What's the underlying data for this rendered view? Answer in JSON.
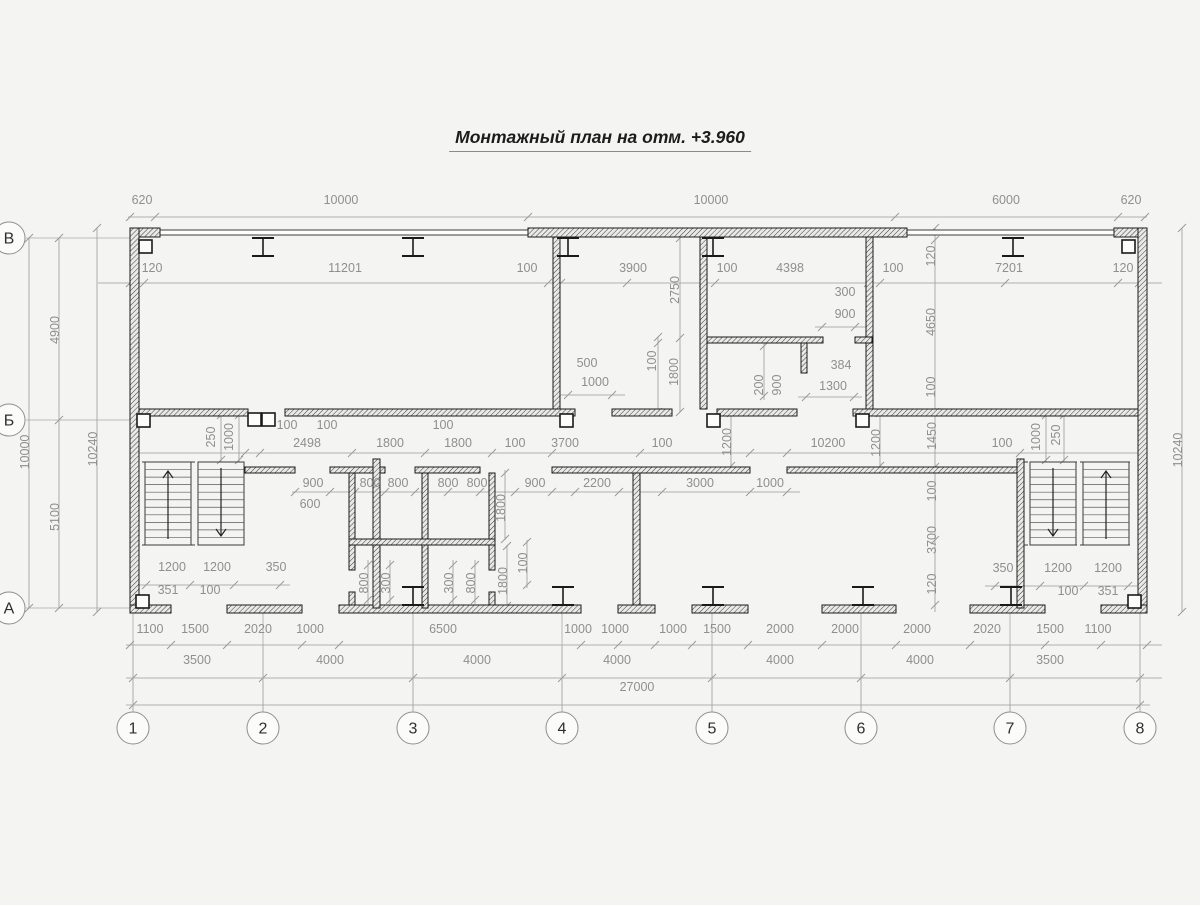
{
  "title": {
    "text": "Монтажный план на отм. +3.960"
  },
  "colors": {
    "wall": "#1a1a1a",
    "thin_wall": "#2a2a2a",
    "dim": "#9a9a9a",
    "dim_text": "#8f8f8f",
    "axis": "#a8a8a8",
    "stair": "#3a3a3a",
    "bg": "#f4f4f2"
  },
  "plan": {
    "axis_circles_bottom": [
      {
        "label": "1",
        "x": 133
      },
      {
        "label": "2",
        "x": 263
      },
      {
        "label": "3",
        "x": 413
      },
      {
        "label": "4",
        "x": 562
      },
      {
        "label": "5",
        "x": 712
      },
      {
        "label": "6",
        "x": 861
      },
      {
        "label": "7",
        "x": 1010
      },
      {
        "label": "8",
        "x": 1140
      }
    ],
    "axis_circles_left": [
      {
        "label": "В",
        "y": 238
      },
      {
        "label": "Б",
        "y": 420
      },
      {
        "label": "А",
        "y": 608
      }
    ],
    "circle_cy": 728,
    "circle_r": 16,
    "circle_cx_left": 9,
    "walls_hatched": [
      [
        130,
        228,
        30,
        9
      ],
      [
        528,
        228,
        379,
        9
      ],
      [
        1114,
        228,
        33,
        9
      ],
      [
        130,
        228,
        9,
        384
      ],
      [
        1138,
        228,
        9,
        384
      ],
      [
        130,
        605,
        41,
        8
      ],
      [
        227,
        605,
        75,
        8
      ],
      [
        339,
        605,
        242,
        8
      ],
      [
        618,
        605,
        37,
        8
      ],
      [
        692,
        605,
        56,
        8
      ],
      [
        822,
        605,
        74,
        8
      ],
      [
        970,
        605,
        75,
        8
      ],
      [
        1101,
        605,
        46,
        8
      ],
      [
        139,
        409,
        109,
        7
      ],
      [
        285,
        409,
        290,
        7
      ],
      [
        612,
        409,
        60,
        7
      ],
      [
        717,
        409,
        80,
        7
      ],
      [
        853,
        409,
        285,
        7
      ],
      [
        245,
        467,
        50,
        6
      ],
      [
        330,
        467,
        55,
        6
      ],
      [
        415,
        467,
        65,
        6
      ],
      [
        552,
        467,
        198,
        6
      ],
      [
        787,
        467,
        233,
        6
      ],
      [
        553,
        237,
        7,
        172
      ],
      [
        700,
        237,
        7,
        172
      ],
      [
        866,
        237,
        7,
        172
      ],
      [
        707,
        337,
        116,
        6
      ],
      [
        855,
        337,
        17,
        6
      ],
      [
        801,
        343,
        6,
        30
      ],
      [
        373,
        459,
        7,
        149
      ],
      [
        1017,
        459,
        7,
        149
      ],
      [
        349,
        473,
        6,
        97
      ],
      [
        349,
        592,
        6,
        13
      ],
      [
        422,
        473,
        6,
        135
      ],
      [
        489,
        473,
        6,
        97
      ],
      [
        489,
        592,
        6,
        13
      ],
      [
        349,
        539,
        146,
        6
      ],
      [
        633,
        473,
        7,
        132
      ]
    ],
    "walls_thin": [
      [
        158,
        230,
        372,
        5
      ],
      [
        905,
        230,
        211,
        5
      ]
    ],
    "columns": [
      [
        139,
        240
      ],
      [
        1122,
        240
      ],
      [
        136,
        595
      ],
      [
        1128,
        595
      ],
      [
        137,
        414
      ],
      [
        248,
        413
      ],
      [
        262,
        413
      ],
      [
        560,
        414
      ],
      [
        707,
        414
      ],
      [
        856,
        414
      ]
    ],
    "ibeams_top": [
      263,
      413,
      568,
      713,
      1013
    ],
    "ibeams_bottom": [
      413,
      563,
      713,
      863,
      1011
    ],
    "stairs": [
      {
        "x": 142,
        "w": 103,
        "y": 462,
        "h": 83,
        "flights": [
          {
            "x": 145,
            "w": 46,
            "dir": "up",
            "ax": 168
          },
          {
            "x": 198,
            "w": 46,
            "dir": "down",
            "ax": 221
          }
        ]
      },
      {
        "x": 1024,
        "w": 106,
        "y": 462,
        "h": 83,
        "flights": [
          {
            "x": 1030,
            "w": 46,
            "dir": "down",
            "ax": 1053
          },
          {
            "x": 1083,
            "w": 46,
            "dir": "up",
            "ax": 1106
          }
        ]
      }
    ],
    "axis_lines_v": {
      "xs": [
        133,
        263,
        413,
        562,
        712,
        861,
        1010,
        1140
      ],
      "y1": 612,
      "y2": 711
    },
    "axis_lines_h": {
      "ys": [
        238,
        420,
        608
      ],
      "x1": 26,
      "x2": 130
    },
    "dim_lines": [
      {
        "o": "h",
        "p": 217,
        "f": 128,
        "t": 1147,
        "ticks": [
          130,
          155,
          528,
          895,
          1118,
          1145
        ]
      },
      {
        "o": "h",
        "p": 283,
        "f": 98,
        "t": 1162,
        "ticks": [
          130,
          144,
          548,
          561,
          627,
          703,
          715,
          868,
          880,
          1005,
          1118,
          1139
        ]
      },
      {
        "o": "h",
        "p": 453,
        "f": 130,
        "t": 1147,
        "ticks": [
          245,
          260,
          352,
          425,
          492,
          552,
          640,
          750,
          787,
          1020
        ]
      },
      {
        "o": "h",
        "p": 492,
        "f": 292,
        "t": 800,
        "ticks": [
          295,
          330,
          355,
          385,
          415,
          448,
          480,
          515,
          552,
          575,
          619,
          662,
          750,
          787
        ]
      },
      {
        "o": "h",
        "p": 645,
        "f": 126,
        "t": 1162,
        "ticks": [
          130,
          171,
          227,
          302,
          339,
          581,
          618,
          655,
          692,
          748,
          822,
          896,
          970,
          1045,
          1101,
          1147
        ]
      },
      {
        "o": "h",
        "p": 678,
        "f": 126,
        "t": 1162,
        "ticks": [
          133,
          263,
          413,
          562,
          712,
          861,
          1010,
          1140
        ]
      },
      {
        "o": "h",
        "p": 705,
        "f": 126,
        "t": 1150,
        "ticks": [
          133,
          1140
        ]
      },
      {
        "o": "h",
        "p": 585,
        "f": 134,
        "t": 290,
        "ticks": [
          146,
          190,
          234,
          280
        ]
      },
      {
        "o": "h",
        "p": 586,
        "f": 985,
        "t": 1140,
        "ticks": [
          995,
          1040,
          1084,
          1128
        ]
      },
      {
        "o": "h",
        "p": 395,
        "f": 558,
        "t": 625,
        "ticks": [
          568,
          612
        ]
      },
      {
        "o": "h",
        "p": 327,
        "f": 815,
        "t": 868,
        "ticks": [
          822,
          855
        ]
      },
      {
        "o": "h",
        "p": 397,
        "f": 798,
        "t": 862,
        "ticks": [
          806,
          854
        ]
      },
      {
        "o": "v",
        "p": 29,
        "f": 238,
        "t": 608,
        "ticks": [
          238,
          608
        ]
      },
      {
        "o": "v",
        "p": 59,
        "f": 238,
        "t": 608,
        "ticks": [
          238,
          420,
          608
        ]
      },
      {
        "o": "v",
        "p": 97,
        "f": 228,
        "t": 612,
        "ticks": [
          228,
          612
        ]
      },
      {
        "o": "v",
        "p": 1182,
        "f": 228,
        "t": 612,
        "ticks": [
          228,
          612
        ]
      },
      {
        "o": "v",
        "p": 680,
        "f": 238,
        "t": 412,
        "ticks": [
          238,
          338,
          412
        ]
      },
      {
        "o": "v",
        "p": 658,
        "f": 337,
        "t": 412,
        "ticks": [
          337,
          343,
          412
        ]
      },
      {
        "o": "v",
        "p": 935,
        "f": 228,
        "t": 612,
        "ticks": [
          228,
          240,
          412,
          467,
          540,
          605
        ]
      },
      {
        "o": "v",
        "p": 731,
        "f": 412,
        "t": 467,
        "ticks": [
          413,
          466
        ]
      },
      {
        "o": "v",
        "p": 880,
        "f": 412,
        "t": 467,
        "ticks": [
          413,
          466
        ]
      },
      {
        "o": "v",
        "p": 221,
        "f": 412,
        "t": 462,
        "ticks": [
          415,
          460
        ]
      },
      {
        "o": "v",
        "p": 239,
        "f": 412,
        "t": 462,
        "ticks": [
          415,
          460
        ]
      },
      {
        "o": "v",
        "p": 1046,
        "f": 412,
        "t": 462,
        "ticks": [
          415,
          460
        ]
      },
      {
        "o": "v",
        "p": 1064,
        "f": 412,
        "t": 462,
        "ticks": [
          415,
          460
        ]
      },
      {
        "o": "v",
        "p": 505,
        "f": 470,
        "t": 540,
        "ticks": [
          473,
          539
        ]
      },
      {
        "o": "v",
        "p": 507,
        "f": 545,
        "t": 608,
        "ticks": [
          546,
          606
        ]
      },
      {
        "o": "v",
        "p": 527,
        "f": 540,
        "t": 588,
        "ticks": [
          542,
          585
        ]
      },
      {
        "o": "v",
        "p": 368,
        "f": 560,
        "t": 604,
        "ticks": [
          565,
          600
        ]
      },
      {
        "o": "v",
        "p": 390,
        "f": 560,
        "t": 604,
        "ticks": [
          565,
          600
        ]
      },
      {
        "o": "v",
        "p": 453,
        "f": 560,
        "t": 604,
        "ticks": [
          565,
          600
        ]
      },
      {
        "o": "v",
        "p": 475,
        "f": 560,
        "t": 604,
        "ticks": [
          565,
          600
        ]
      },
      {
        "o": "v",
        "p": 764,
        "f": 343,
        "t": 400,
        "ticks": [
          346,
          396
        ]
      }
    ],
    "labels": [
      {
        "t": "620",
        "x": 142,
        "y": 204
      },
      {
        "t": "10000",
        "x": 341,
        "y": 204
      },
      {
        "t": "10000",
        "x": 711,
        "y": 204
      },
      {
        "t": "6000",
        "x": 1006,
        "y": 204
      },
      {
        "t": "620",
        "x": 1131,
        "y": 204
      },
      {
        "t": "120",
        "x": 152,
        "y": 272
      },
      {
        "t": "11201",
        "x": 345,
        "y": 272
      },
      {
        "t": "100",
        "x": 527,
        "y": 272
      },
      {
        "t": "3900",
        "x": 633,
        "y": 272
      },
      {
        "t": "100",
        "x": 727,
        "y": 272
      },
      {
        "t": "4398",
        "x": 790,
        "y": 272
      },
      {
        "t": "100",
        "x": 893,
        "y": 272
      },
      {
        "t": "7201",
        "x": 1009,
        "y": 272
      },
      {
        "t": "120",
        "x": 1123,
        "y": 272
      },
      {
        "t": "4900",
        "x": 59,
        "y": 330,
        "r": 1
      },
      {
        "t": "10000",
        "x": 29,
        "y": 452,
        "r": 1
      },
      {
        "t": "5100",
        "x": 59,
        "y": 517,
        "r": 1
      },
      {
        "t": "10240",
        "x": 97,
        "y": 449,
        "r": 1
      },
      {
        "t": "10240",
        "x": 1182,
        "y": 450,
        "r": 1
      },
      {
        "t": "2750",
        "x": 679,
        "y": 290,
        "r": 1
      },
      {
        "t": "500",
        "x": 587,
        "y": 367
      },
      {
        "t": "1000",
        "x": 595,
        "y": 386
      },
      {
        "t": "100",
        "x": 656,
        "y": 361,
        "r": 1
      },
      {
        "t": "1800",
        "x": 678,
        "y": 372,
        "r": 1
      },
      {
        "t": "300",
        "x": 845,
        "y": 296
      },
      {
        "t": "900",
        "x": 845,
        "y": 318
      },
      {
        "t": "200",
        "x": 763,
        "y": 385,
        "r": 1
      },
      {
        "t": "900",
        "x": 781,
        "y": 385,
        "r": 1
      },
      {
        "t": "384",
        "x": 841,
        "y": 369
      },
      {
        "t": "1300",
        "x": 833,
        "y": 390
      },
      {
        "t": "120",
        "x": 935,
        "y": 256,
        "r": 1
      },
      {
        "t": "4650",
        "x": 935,
        "y": 322,
        "r": 1
      },
      {
        "t": "100",
        "x": 935,
        "y": 387,
        "r": 1
      },
      {
        "t": "2498",
        "x": 307,
        "y": 447
      },
      {
        "t": "1800",
        "x": 390,
        "y": 447
      },
      {
        "t": "1800",
        "x": 458,
        "y": 447
      },
      {
        "t": "100",
        "x": 515,
        "y": 447
      },
      {
        "t": "3700",
        "x": 565,
        "y": 447
      },
      {
        "t": "100",
        "x": 662,
        "y": 447
      },
      {
        "t": "10200",
        "x": 828,
        "y": 447
      },
      {
        "t": "100",
        "x": 1002,
        "y": 447
      },
      {
        "t": "100",
        "x": 287,
        "y": 429
      },
      {
        "t": "100",
        "x": 327,
        "y": 429
      },
      {
        "t": "100",
        "x": 443,
        "y": 429
      },
      {
        "t": "250",
        "x": 215,
        "y": 437,
        "r": 1
      },
      {
        "t": "1000",
        "x": 233,
        "y": 437,
        "r": 1
      },
      {
        "t": "1200",
        "x": 731,
        "y": 442,
        "r": 1
      },
      {
        "t": "1200",
        "x": 880,
        "y": 443,
        "r": 1
      },
      {
        "t": "1450",
        "x": 936,
        "y": 436,
        "r": 1
      },
      {
        "t": "1000",
        "x": 1040,
        "y": 437,
        "r": 1
      },
      {
        "t": "250",
        "x": 1060,
        "y": 435,
        "r": 1
      },
      {
        "t": "900",
        "x": 313,
        "y": 487
      },
      {
        "t": "800",
        "x": 370,
        "y": 487
      },
      {
        "t": "800",
        "x": 398,
        "y": 487
      },
      {
        "t": "800",
        "x": 448,
        "y": 487
      },
      {
        "t": "800",
        "x": 477,
        "y": 487
      },
      {
        "t": "900",
        "x": 535,
        "y": 487
      },
      {
        "t": "2200",
        "x": 597,
        "y": 487
      },
      {
        "t": "3000",
        "x": 700,
        "y": 487
      },
      {
        "t": "1000",
        "x": 770,
        "y": 487
      },
      {
        "t": "600",
        "x": 310,
        "y": 508
      },
      {
        "t": "1800",
        "x": 505,
        "y": 508,
        "r": 1
      },
      {
        "t": "100",
        "x": 527,
        "y": 563,
        "r": 1
      },
      {
        "t": "1800",
        "x": 507,
        "y": 581,
        "r": 1
      },
      {
        "t": "100",
        "x": 936,
        "y": 491,
        "r": 1
      },
      {
        "t": "3700",
        "x": 936,
        "y": 540,
        "r": 1
      },
      {
        "t": "120",
        "x": 936,
        "y": 584,
        "r": 1
      },
      {
        "t": "800",
        "x": 368,
        "y": 583,
        "r": 1
      },
      {
        "t": "300",
        "x": 390,
        "y": 583,
        "r": 1
      },
      {
        "t": "300",
        "x": 453,
        "y": 583,
        "r": 1
      },
      {
        "t": "800",
        "x": 475,
        "y": 583,
        "r": 1
      },
      {
        "t": "1200",
        "x": 172,
        "y": 571
      },
      {
        "t": "1200",
        "x": 217,
        "y": 571
      },
      {
        "t": "350",
        "x": 276,
        "y": 571
      },
      {
        "t": "351",
        "x": 168,
        "y": 594
      },
      {
        "t": "100",
        "x": 210,
        "y": 594
      },
      {
        "t": "350",
        "x": 1003,
        "y": 572
      },
      {
        "t": "1200",
        "x": 1058,
        "y": 572
      },
      {
        "t": "1200",
        "x": 1108,
        "y": 572
      },
      {
        "t": "100",
        "x": 1068,
        "y": 595
      },
      {
        "t": "351",
        "x": 1108,
        "y": 595
      },
      {
        "t": "1100",
        "x": 150,
        "y": 633
      },
      {
        "t": "1500",
        "x": 195,
        "y": 633
      },
      {
        "t": "2020",
        "x": 258,
        "y": 633
      },
      {
        "t": "1000",
        "x": 310,
        "y": 633
      },
      {
        "t": "6500",
        "x": 443,
        "y": 633
      },
      {
        "t": "1000",
        "x": 578,
        "y": 633
      },
      {
        "t": "1000",
        "x": 615,
        "y": 633
      },
      {
        "t": "1000",
        "x": 673,
        "y": 633
      },
      {
        "t": "1500",
        "x": 717,
        "y": 633
      },
      {
        "t": "2000",
        "x": 780,
        "y": 633
      },
      {
        "t": "2000",
        "x": 845,
        "y": 633
      },
      {
        "t": "2000",
        "x": 917,
        "y": 633
      },
      {
        "t": "2020",
        "x": 987,
        "y": 633
      },
      {
        "t": "1500",
        "x": 1050,
        "y": 633
      },
      {
        "t": "1100",
        "x": 1098,
        "y": 633
      },
      {
        "t": "3500",
        "x": 197,
        "y": 664
      },
      {
        "t": "4000",
        "x": 330,
        "y": 664
      },
      {
        "t": "4000",
        "x": 477,
        "y": 664
      },
      {
        "t": "4000",
        "x": 617,
        "y": 664
      },
      {
        "t": "4000",
        "x": 780,
        "y": 664
      },
      {
        "t": "4000",
        "x": 920,
        "y": 664
      },
      {
        "t": "3500",
        "x": 1050,
        "y": 664
      },
      {
        "t": "27000",
        "x": 637,
        "y": 691
      }
    ]
  }
}
